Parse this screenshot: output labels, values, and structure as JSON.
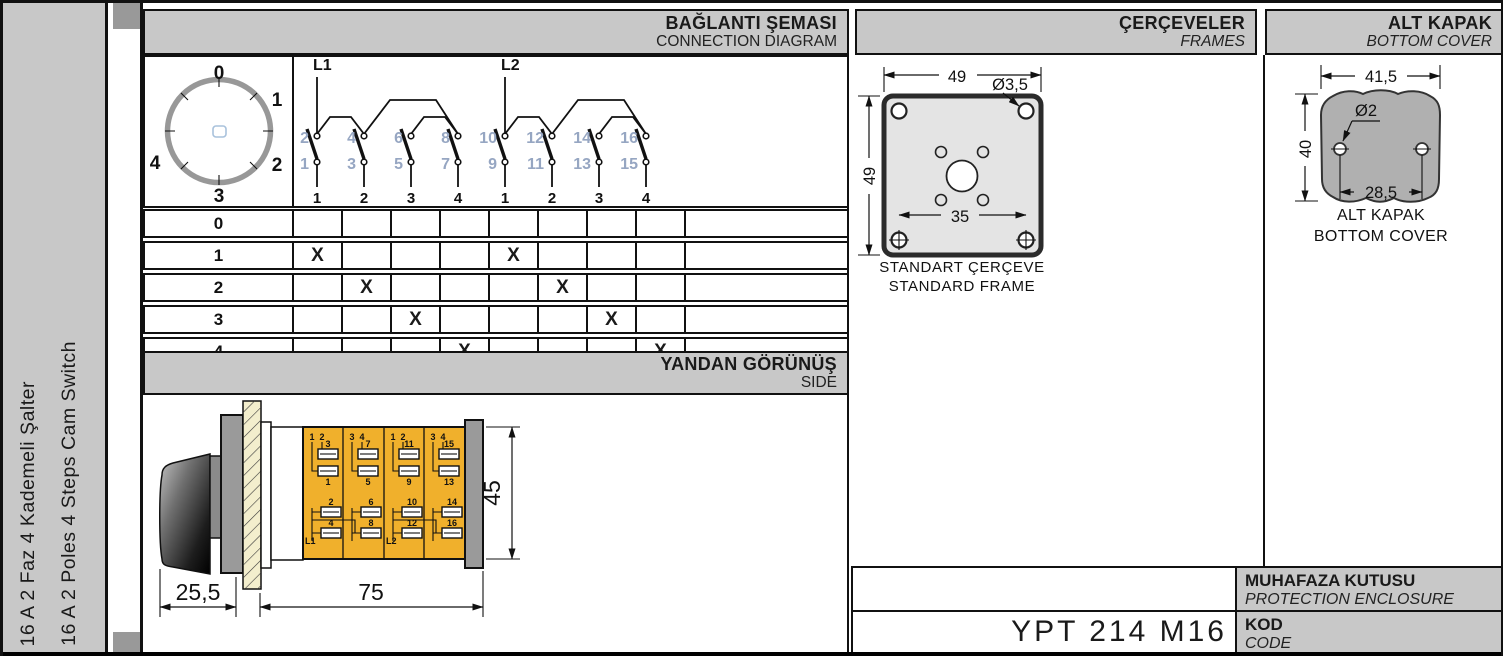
{
  "sidebar": {
    "title_tr": "16 A 2 Faz 4 Kademeli Şalter",
    "title_en": "16 A 2 Poles 4 Steps Cam Switch"
  },
  "headers": {
    "connection": {
      "tr": "BAĞLANTI ŞEMASI",
      "en": "CONNECTION DIAGRAM"
    },
    "frames": {
      "tr": "ÇERÇEVELER",
      "en": "FRAMES"
    },
    "cover": {
      "tr": "ALT KAPAK",
      "en": "BOTTOM COVER"
    },
    "side": {
      "tr": "YANDAN GÖRÜNÜŞ",
      "en": "SIDE"
    }
  },
  "dial": {
    "positions": [
      "0",
      "1",
      "2",
      "3",
      "4"
    ]
  },
  "diagram": {
    "feeds": [
      "L1",
      "L2"
    ],
    "contacts": [
      {
        "top": "2",
        "bottom": "1",
        "pos": "1"
      },
      {
        "top": "4",
        "bottom": "3",
        "pos": "2"
      },
      {
        "top": "6",
        "bottom": "5",
        "pos": "3"
      },
      {
        "top": "8",
        "bottom": "7",
        "pos": "4"
      },
      {
        "top": "10",
        "bottom": "9",
        "pos": "1"
      },
      {
        "top": "12",
        "bottom": "11",
        "pos": "2"
      },
      {
        "top": "14",
        "bottom": "13",
        "pos": "3"
      },
      {
        "top": "16",
        "bottom": "15",
        "pos": "4"
      }
    ]
  },
  "switch_table": {
    "row_labels": [
      "0",
      "1",
      "2",
      "3",
      "4"
    ],
    "marks": [
      [
        "",
        "",
        "",
        "",
        "",
        "",
        "",
        ""
      ],
      [
        "X",
        "",
        "",
        "",
        "X",
        "",
        "",
        ""
      ],
      [
        "",
        "X",
        "",
        "",
        "",
        "X",
        "",
        ""
      ],
      [
        "",
        "",
        "X",
        "",
        "",
        "",
        "X",
        ""
      ],
      [
        "",
        "",
        "",
        "X",
        "",
        "",
        "",
        "X"
      ]
    ]
  },
  "frame": {
    "dim_top": "49",
    "dim_left": "49",
    "hole_dia": "Ø3,5",
    "dim_inner": "35",
    "caption_tr": "STANDART ÇERÇEVE",
    "caption_en": "STANDARD FRAME"
  },
  "cover": {
    "dim_top": "41,5",
    "dim_left": "40",
    "hole_dia": "Ø2",
    "dim_holes": "28,5",
    "caption_tr": "ALT KAPAK",
    "caption_en": "BOTTOM COVER"
  },
  "side_view": {
    "dim_knob": "25,5",
    "dim_body": "75",
    "dim_height": "45",
    "sections": [
      {
        "pair_a": "1",
        "pair_b": "2",
        "upper_num": "3",
        "lower_num": "1",
        "bot_a": "2",
        "bot_b": "4",
        "feed": "L1"
      },
      {
        "pair_a": "3",
        "pair_b": "4",
        "upper_num": "7",
        "lower_num": "5",
        "bot_a": "6",
        "bot_b": "8",
        "feed": ""
      },
      {
        "pair_a": "1",
        "pair_b": "2",
        "upper_num": "11",
        "lower_num": "9",
        "bot_a": "10",
        "bot_b": "12",
        "feed": "L2"
      },
      {
        "pair_a": "3",
        "pair_b": "4",
        "upper_num": "15",
        "lower_num": "13",
        "bot_a": "14",
        "bot_b": "16",
        "feed": ""
      }
    ]
  },
  "footer": {
    "enclosure_tr": "MUHAFAZA KUTUSU",
    "enclosure_en": "PROTECTION ENCLOSURE",
    "code_tr": "KOD",
    "code_en": "CODE",
    "code_value": "YPT 214 M16"
  },
  "colors": {
    "header_bg": "#c8c8c8",
    "body_yellow": "#f0b02c",
    "terminal_number_blue": "#96a6c2",
    "frame_fill": "#e4e4e4",
    "cover_fill": "#b0b0b0",
    "hatch_fill": "#f3eecd"
  }
}
